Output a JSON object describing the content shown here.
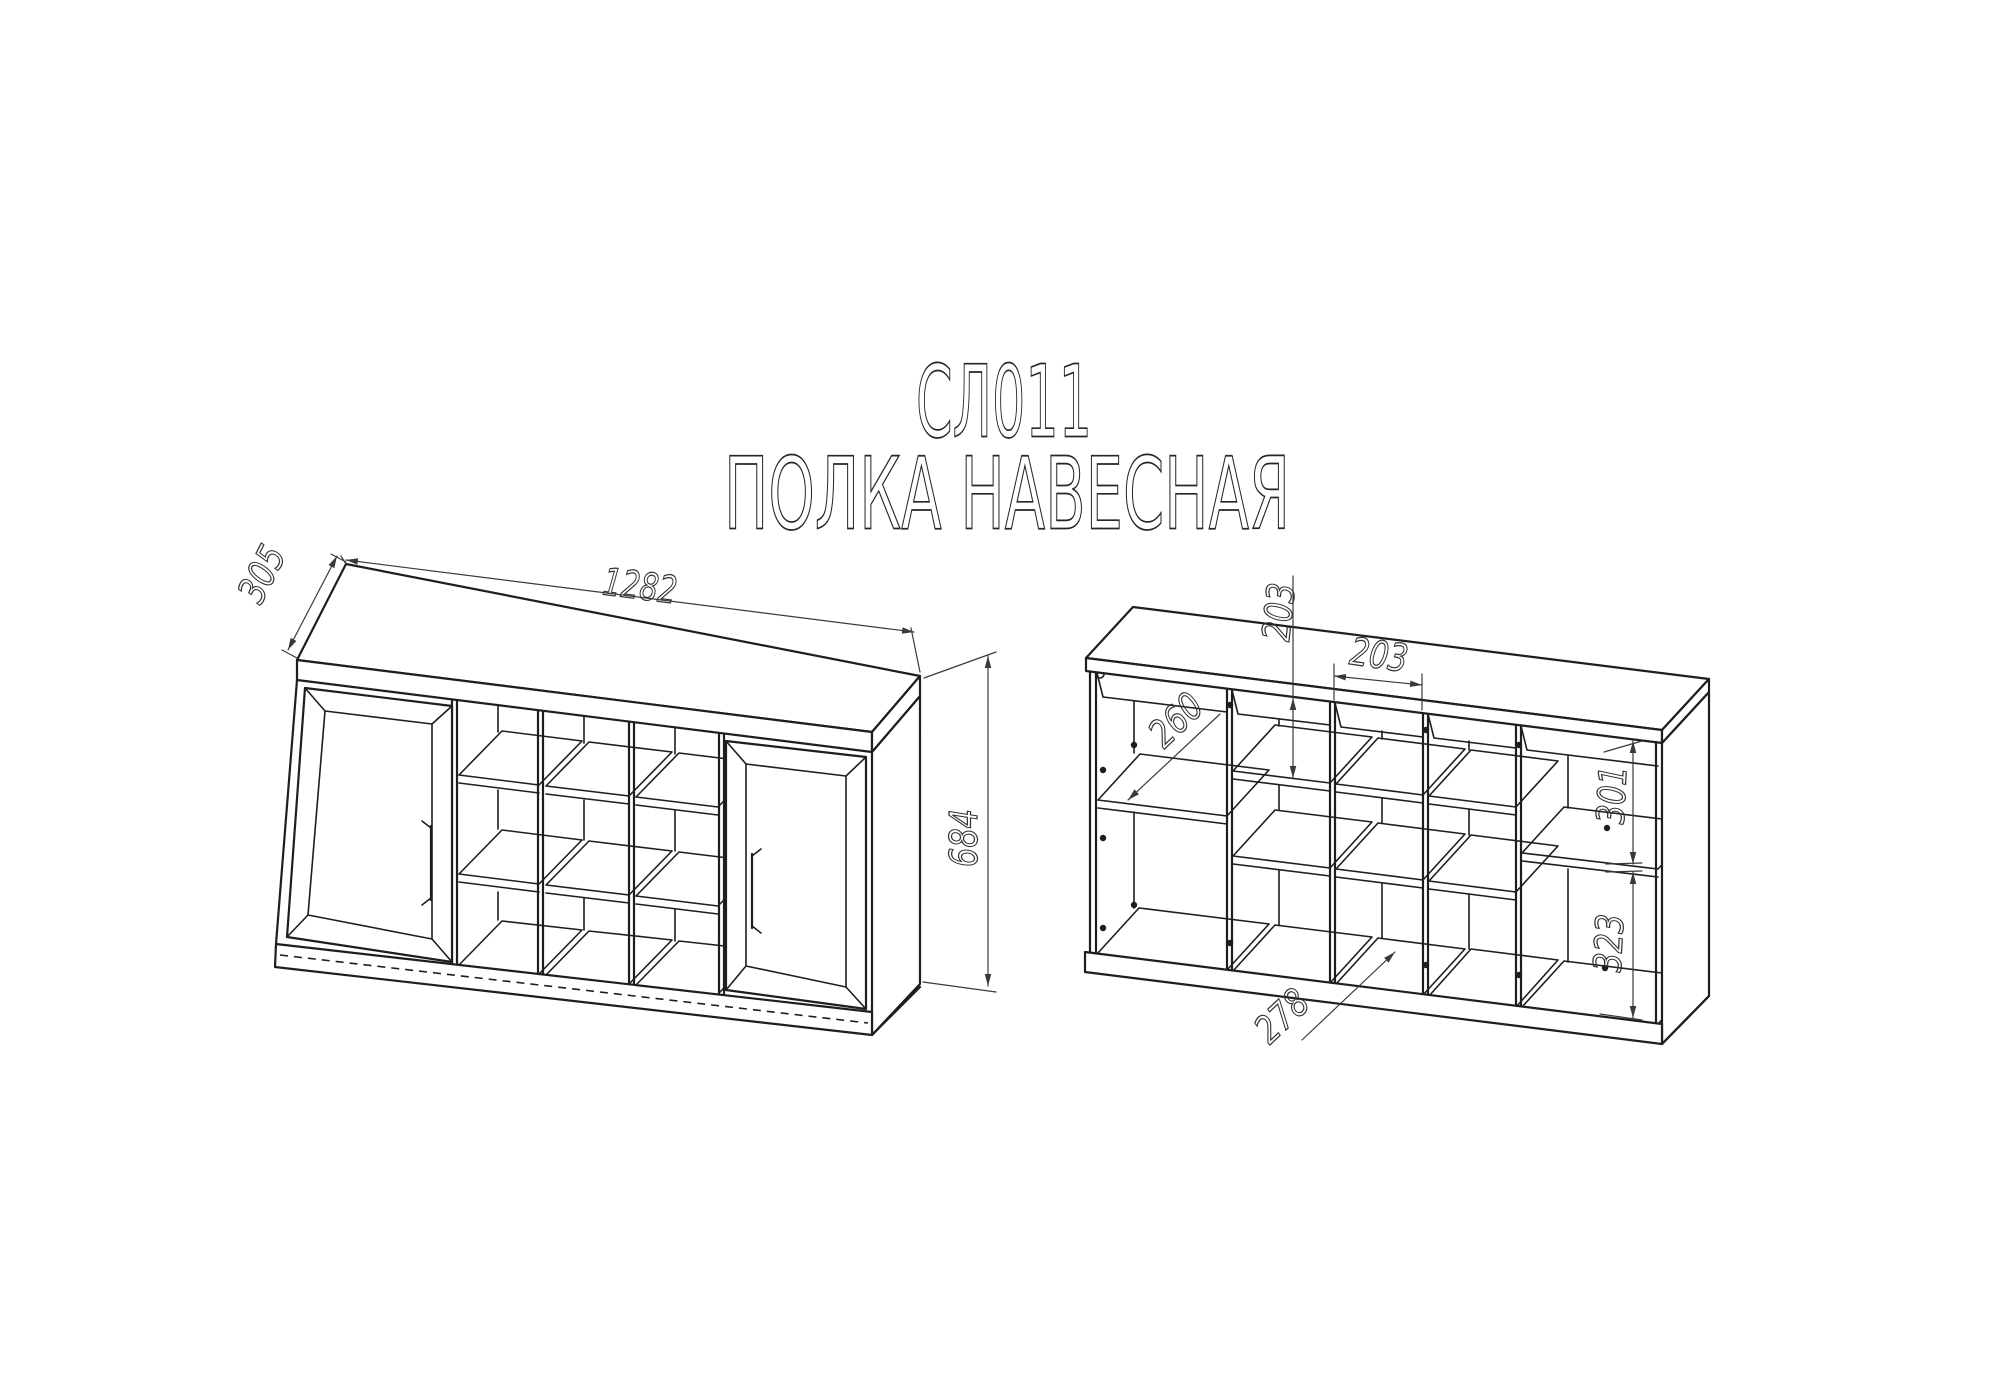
{
  "title": {
    "model": "СЛ011",
    "name": "ПОЛКА НАВЕСНАЯ"
  },
  "views": {
    "closed": {
      "width": "1282",
      "depth": "305",
      "height": "684"
    },
    "open": {
      "cell_height": "203",
      "cell_width": "203",
      "shelf_depth": "260",
      "upper_right_cell": "301",
      "lower_right_cell": "323",
      "lower_cell": "278"
    }
  }
}
